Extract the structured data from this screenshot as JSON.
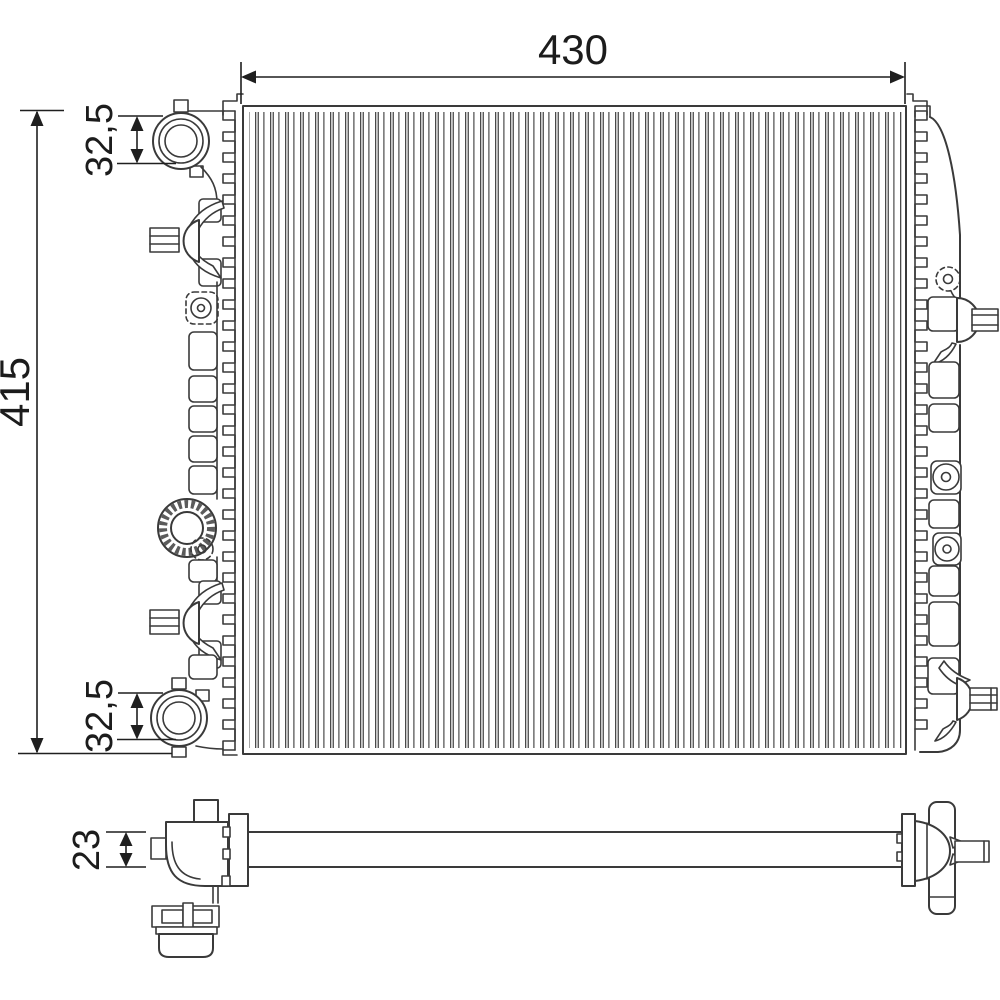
{
  "colors": {
    "background": "#ffffff",
    "line": "#3a3a3a",
    "dimension_line": "#1f1f1f",
    "text": "#1c1c1c"
  },
  "dimensions": {
    "core_width": "430",
    "core_height": "415",
    "top_port_diameter": "32,5",
    "bottom_port_diameter": "32,5",
    "profile_thickness": "23"
  }
}
